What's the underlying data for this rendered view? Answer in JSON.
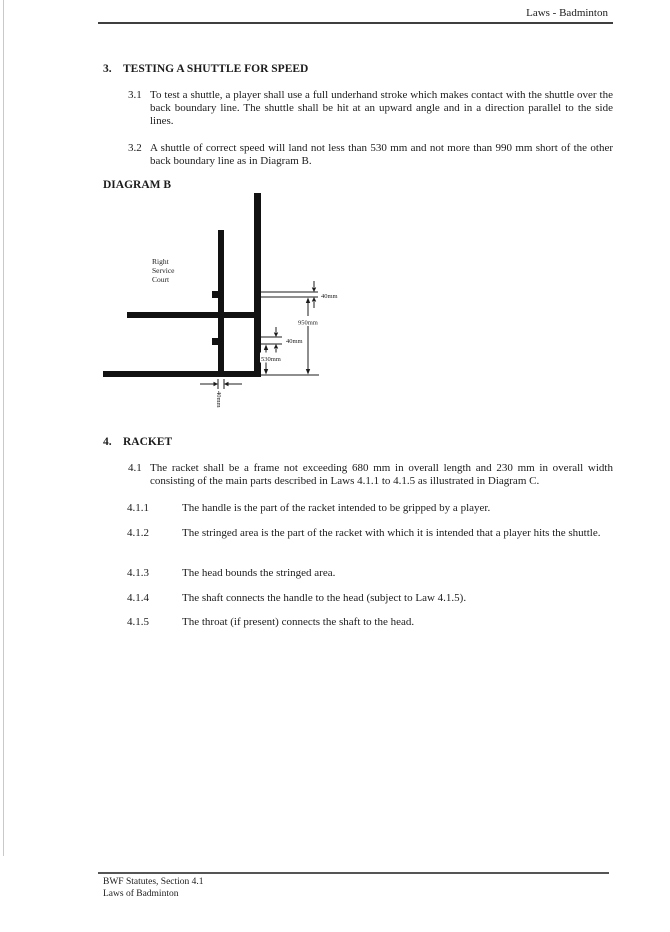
{
  "header": {
    "title": "Laws - Badminton"
  },
  "section3": {
    "number": "3.",
    "title": "TESTING A SHUTTLE FOR SPEED",
    "items": [
      {
        "number": "3.1",
        "text": "To test a shuttle, a player shall use a full underhand stroke which makes contact with the shuttle over the back boundary line. The shuttle shall be hit at an upward angle and in a direction parallel to the side lines."
      },
      {
        "number": "3.2",
        "text": "A shuttle of correct speed will land not less than 530 mm and not more than 990 mm short of the other back boundary line as in Diagram B."
      }
    ]
  },
  "diagram": {
    "heading": "DIAGRAM B",
    "court_label": [
      "Right",
      "Service",
      "Court"
    ],
    "dimensions": {
      "line_width_top": "40mm",
      "long_distance": "950mm",
      "line_width_mid": "40mm",
      "short_distance": "530mm",
      "line_width_bottom": "40mm"
    }
  },
  "section4": {
    "number": "4.",
    "title": "RACKET",
    "intro": {
      "number": "4.1",
      "text": "The racket shall be a frame not exceeding 680 mm in overall length and 230 mm in overall width consisting of the main parts described in Laws 4.1.1 to 4.1.5 as illustrated in Diagram C."
    },
    "items": [
      {
        "number": "4.1.1",
        "text": "The handle is the part of the racket intended to be gripped by a player."
      },
      {
        "number": "4.1.2",
        "text": "The stringed area is the part of the racket with which it is intended that a player hits the shuttle."
      },
      {
        "number": "4.1.3",
        "text": "The head bounds the stringed area."
      },
      {
        "number": "4.1.4",
        "text": "The shaft connects the handle to the head (subject to Law 4.1.5)."
      },
      {
        "number": "4.1.5",
        "text": "The throat (if present) connects the shaft to the head."
      }
    ]
  },
  "footer": {
    "line1": "BWF Statutes, Section 4.1",
    "line2": "Laws of Badminton"
  }
}
